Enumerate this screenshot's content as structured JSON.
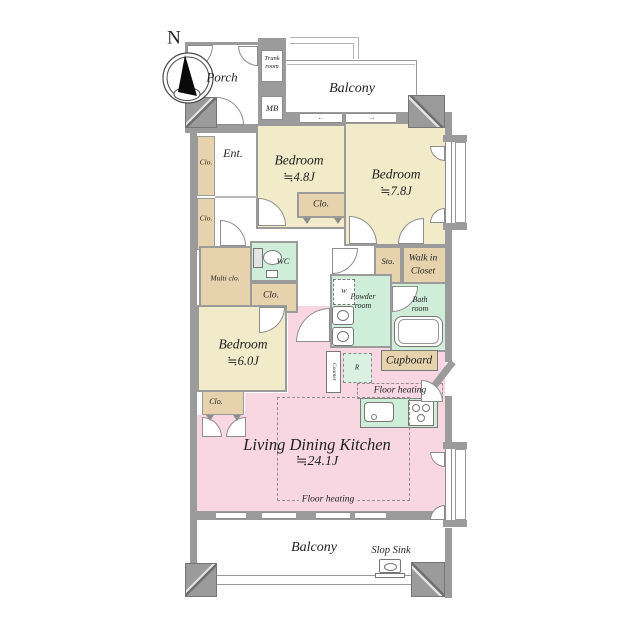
{
  "compass": {
    "north_label": "N"
  },
  "colors": {
    "wall": "#9b9b9b",
    "bedroom_fill": "#f1ebca",
    "closet_fill": "#e6d3ad",
    "wet_area_fill": "#cfeeda",
    "ldk_fill": "#f8d7e2",
    "text": "#1f1f1f"
  },
  "rooms": {
    "porch": {
      "label": "Porch"
    },
    "trunk_room": {
      "line1": "Trunk",
      "line2": "room"
    },
    "meter_box": {
      "label": "MB"
    },
    "balcony_top": {
      "label": "Balcony"
    },
    "entrance": {
      "label": "Ent."
    },
    "closet_abbr": {
      "label": "Clo."
    },
    "bedroom_48": {
      "label": "Bedroom",
      "size": "≒4.8J"
    },
    "bedroom_78": {
      "label": "Bedroom",
      "size": "≒7.8J"
    },
    "bedroom_60": {
      "label": "Bedroom",
      "size": "≒6.0J"
    },
    "multi_closet": {
      "label": "Multi clo."
    },
    "wc": {
      "label": "WC"
    },
    "storage": {
      "label": "Sto."
    },
    "walk_in_closet": {
      "line1": "Walk in",
      "line2": "Closet"
    },
    "powder_room": {
      "line1": "Powder",
      "line2": "room"
    },
    "bath_room": {
      "line1": "Bath",
      "line2": "room"
    },
    "washing_machine": {
      "label": "W"
    },
    "refrigerator": {
      "label": "R"
    },
    "counter": {
      "label": "Counter"
    },
    "cupboard": {
      "label": "Cupboard"
    },
    "floor_heating": {
      "label": "Floor heating"
    },
    "ldk": {
      "label": "Living Dining Kitchen",
      "size": "≒24.1J"
    },
    "balcony_bottom": {
      "label": "Balcony"
    },
    "slop_sink": {
      "label": "Slop Sink"
    }
  },
  "icons": {
    "slide_arrow_left": "←",
    "slide_arrow_right": "→"
  }
}
